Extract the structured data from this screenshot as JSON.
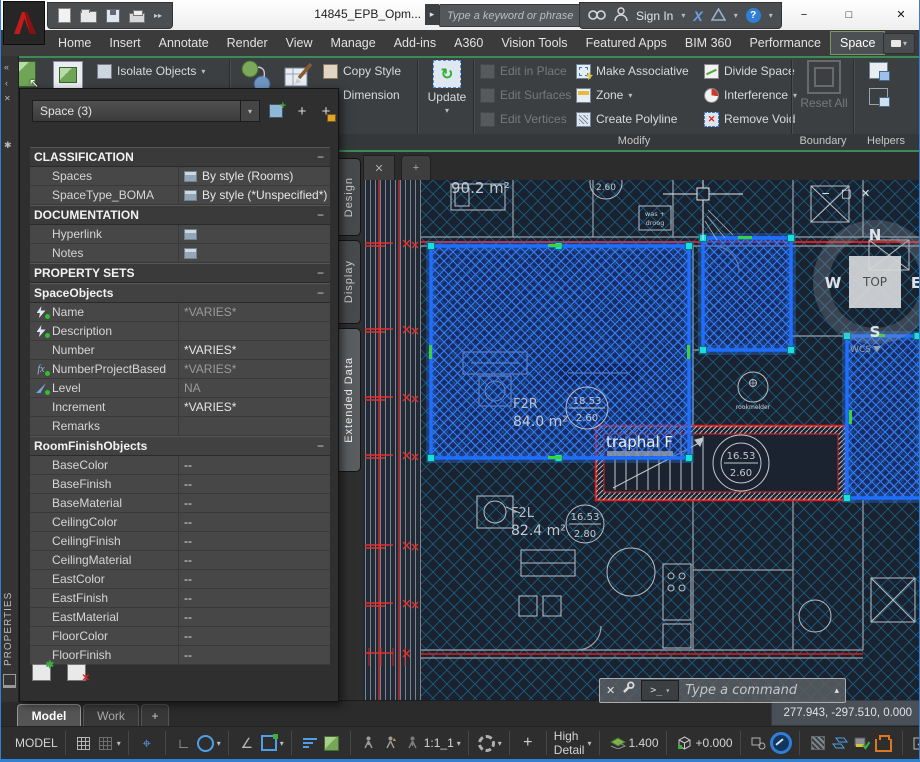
{
  "window": {
    "doc_title": "14845_EPB_Opm...",
    "search_placeholder": "Type a keyword or phrase",
    "sign_in_label": "Sign In",
    "exchange_x": "X"
  },
  "ribbon": {
    "tabs": [
      "Home",
      "Insert",
      "Annotate",
      "Render",
      "View",
      "Manage",
      "Add-ins",
      "A360",
      "Vision Tools",
      "Featured Apps",
      "BIM 360",
      "Performance",
      "Space"
    ],
    "buttons": {
      "isolate_objects": "Isolate Objects",
      "edit_in_section": "Edit in Section",
      "copy_style": "Copy Style",
      "dimension": "Dimension",
      "update": "Update",
      "edit_in_place": "Edit in Place",
      "edit_surfaces": "Edit Surfaces",
      "edit_vertices": "Edit Vertices",
      "make_associative": "Make Associative",
      "zone": "Zone",
      "create_polyline": "Create Polyline",
      "divide_space": "Divide Space",
      "interference": "Interference",
      "remove_void": "Remove Void",
      "reset_all": "Reset All"
    },
    "panels": {
      "modify": "Modify",
      "boundary": "Boundary",
      "helpers": "Helpers"
    }
  },
  "palette": {
    "title": "PROPERTIES",
    "selection": "Space (3)",
    "tabs": [
      "Design",
      "Display",
      "Extended Data"
    ],
    "collapse_glyph": "−",
    "grid": [
      {
        "t": "h",
        "label": "CLASSIFICATION"
      },
      {
        "t": "r",
        "label": "Spaces",
        "value": "By style (Rooms)"
      },
      {
        "t": "r",
        "label": "SpaceType_BOMA",
        "value": "By style (*Unspecified*)"
      },
      {
        "t": "h",
        "label": "DOCUMENTATION"
      },
      {
        "t": "r",
        "label": "Hyperlink",
        "value": ""
      },
      {
        "t": "r",
        "label": "Notes",
        "value": ""
      },
      {
        "t": "h",
        "label": "PROPERTY SETS"
      },
      {
        "t": "s",
        "label": "SpaceObjects"
      },
      {
        "t": "r",
        "label": "Name",
        "value": "*VARIES*"
      },
      {
        "t": "r",
        "label": "Description",
        "value": ""
      },
      {
        "t": "r",
        "label": "Number",
        "value": "*VARIES*"
      },
      {
        "t": "r",
        "label": "NumberProjectBased",
        "value": "*VARIES*"
      },
      {
        "t": "r",
        "label": "Level",
        "value": "NA"
      },
      {
        "t": "r",
        "label": "Increment",
        "value": "*VARIES*"
      },
      {
        "t": "r",
        "label": "Remarks",
        "value": ""
      },
      {
        "t": "s",
        "label": "RoomFinishObjects"
      },
      {
        "t": "r",
        "label": "BaseColor",
        "value": "--"
      },
      {
        "t": "r",
        "label": "BaseFinish",
        "value": "--"
      },
      {
        "t": "r",
        "label": "BaseMaterial",
        "value": "--"
      },
      {
        "t": "r",
        "label": "CeilingColor",
        "value": "--"
      },
      {
        "t": "r",
        "label": "CeilingFinish",
        "value": "--"
      },
      {
        "t": "r",
        "label": "CeilingMaterial",
        "value": "--"
      },
      {
        "t": "r",
        "label": "EastColor",
        "value": "--"
      },
      {
        "t": "r",
        "label": "EastFinish",
        "value": "--"
      },
      {
        "t": "r",
        "label": "EastMaterial",
        "value": "--"
      },
      {
        "t": "r",
        "label": "FloorColor",
        "value": "--"
      },
      {
        "t": "r",
        "label": "FloorFinish",
        "value": "--"
      }
    ]
  },
  "canvas": {
    "labels": {
      "area_902": "90.2 m²",
      "tag_260": "2.60",
      "f2r": "F2R",
      "f2r_area": "84.0 m²",
      "f2r_tag_h": "18.53",
      "f2r_tag_c": "2.60",
      "traphal": "traphal F",
      "stair_tag_h": "16.53",
      "stair_tag_c": "2.60",
      "rookmelder": "rookmelder",
      "f2l": "F2L",
      "f2l_area": "82.4 m²",
      "f2l_tag_h": "16.53",
      "f2l_tag_c": "2.80",
      "was_plus": "was +",
      "droog": "droog"
    },
    "viewcube": {
      "face": "TOP",
      "n": "N",
      "e": "E",
      "s": "S",
      "w": "W",
      "wcs": "WCS"
    }
  },
  "cmdline": {
    "placeholder": "Type  a  command",
    "prompt": ">_"
  },
  "layout_tabs": {
    "model": "Model",
    "work": "Work",
    "add": "+"
  },
  "statusbar": {
    "model_label": "MODEL",
    "annotation_scale": "1:1_1",
    "detail_level": "High Detail",
    "cut_plane": "1.400",
    "elevation": "+0.000",
    "coordinates": "277.943, -297.510, 0.000"
  },
  "icons": {
    "chevron_down": "▾",
    "chevron_up": "▴",
    "play": "▸",
    "double_play": "▸▸",
    "close": "✕",
    "minimize": "−",
    "maximize": "□",
    "plus": "+",
    "question": "?",
    "ortho": "∟",
    "angle": "∠",
    "snap": "⌖",
    "pick_left": "‹",
    "pick_left2": "«",
    "asterisk": "✱"
  },
  "colors": {
    "selection_blue": "#2f7dff",
    "highlight_red": "#e02020",
    "hatch_cyan": "#1891c0",
    "grip_cyan": "#19dede",
    "grip_green": "#3bd23b",
    "window_border_blue": "#2f81d6"
  }
}
